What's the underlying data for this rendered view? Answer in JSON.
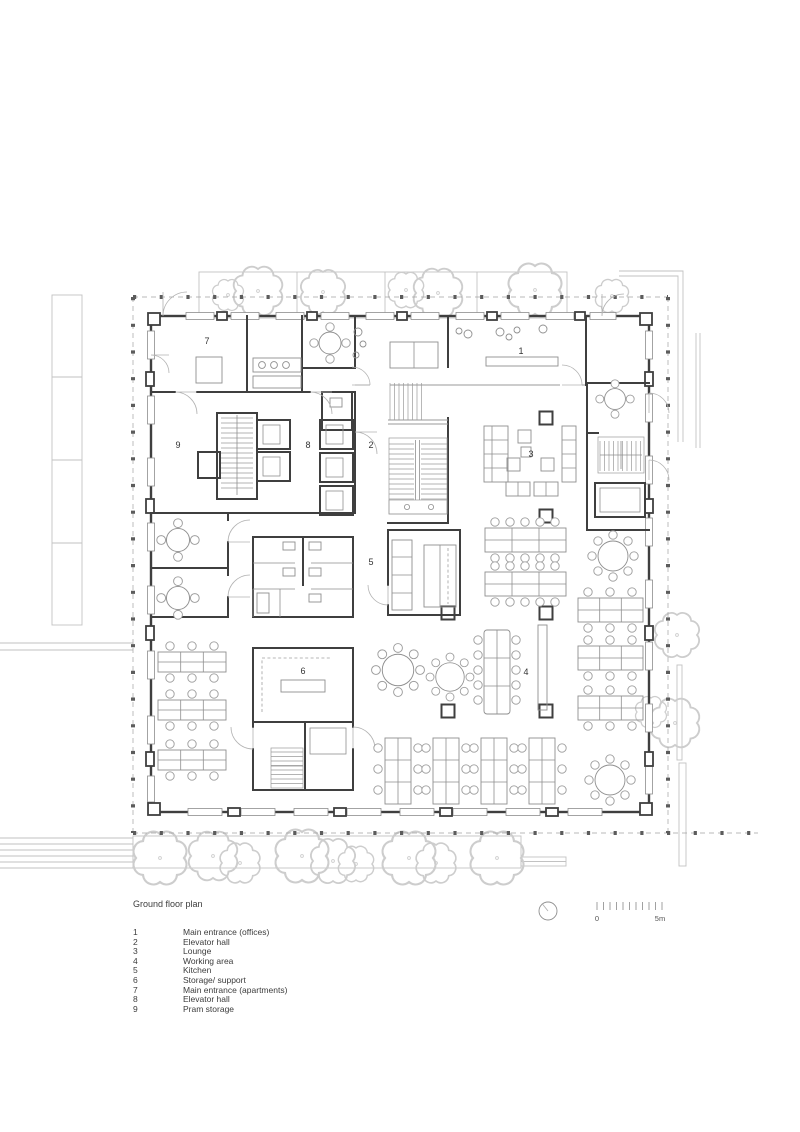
{
  "title": "Ground floor plan",
  "legend": {
    "items": [
      {
        "num": "1",
        "label": "Main entrance (offices)"
      },
      {
        "num": "2",
        "label": "Elevator hall"
      },
      {
        "num": "3",
        "label": "Lounge"
      },
      {
        "num": "4",
        "label": "Working area"
      },
      {
        "num": "5",
        "label": "Kitchen"
      },
      {
        "num": "6",
        "label": "Storage/ support"
      },
      {
        "num": "7",
        "label": "Main entrance (apartments)"
      },
      {
        "num": "8",
        "label": "Elevator hall"
      },
      {
        "num": "9",
        "label": "Pram storage"
      }
    ]
  },
  "scale_bar": {
    "zero_label": "0",
    "end_label": "5m"
  },
  "colors": {
    "wall": "#3f3f3f",
    "furniture": "#8f8f8f",
    "context": "#c2c2c2",
    "boundary": "#a3a3a3",
    "text": "#3c3c3c"
  }
}
